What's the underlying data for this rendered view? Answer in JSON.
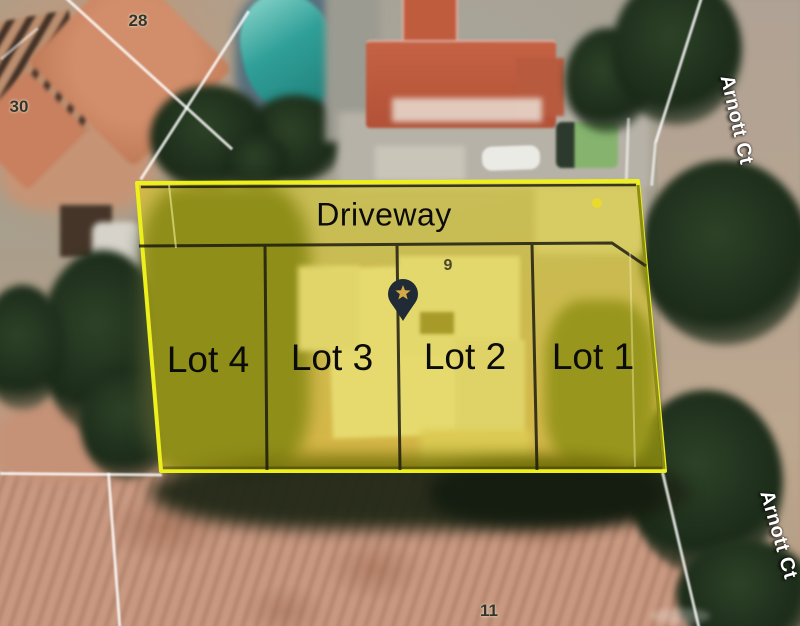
{
  "map": {
    "description": "Aerial satellite photo with a yellow subdivision overlay of four lots and a shared driveway",
    "overlay": {
      "driveway": {
        "label": "Driveway"
      },
      "lots": [
        {
          "label": "Lot 4"
        },
        {
          "label": "Lot 3"
        },
        {
          "label": "Lot 2"
        },
        {
          "label": "Lot 1"
        }
      ],
      "outline_color": "#eef01b",
      "fill_color": "rgba(246,227,0,0.42)",
      "grid_line_color": "#17170f",
      "marker": {
        "icon": "star-pin",
        "glyph": "★",
        "pin_color": "#202b35",
        "star_color": "#d5a944"
      }
    },
    "street_labels": [
      {
        "text": "Arnott Ct",
        "position": "top-right"
      },
      {
        "text": "Arnott Ct",
        "position": "bottom-right"
      }
    ],
    "parcel_numbers": [
      {
        "text": "28"
      },
      {
        "text": "30"
      },
      {
        "text": "9"
      },
      {
        "text": "11"
      }
    ]
  }
}
